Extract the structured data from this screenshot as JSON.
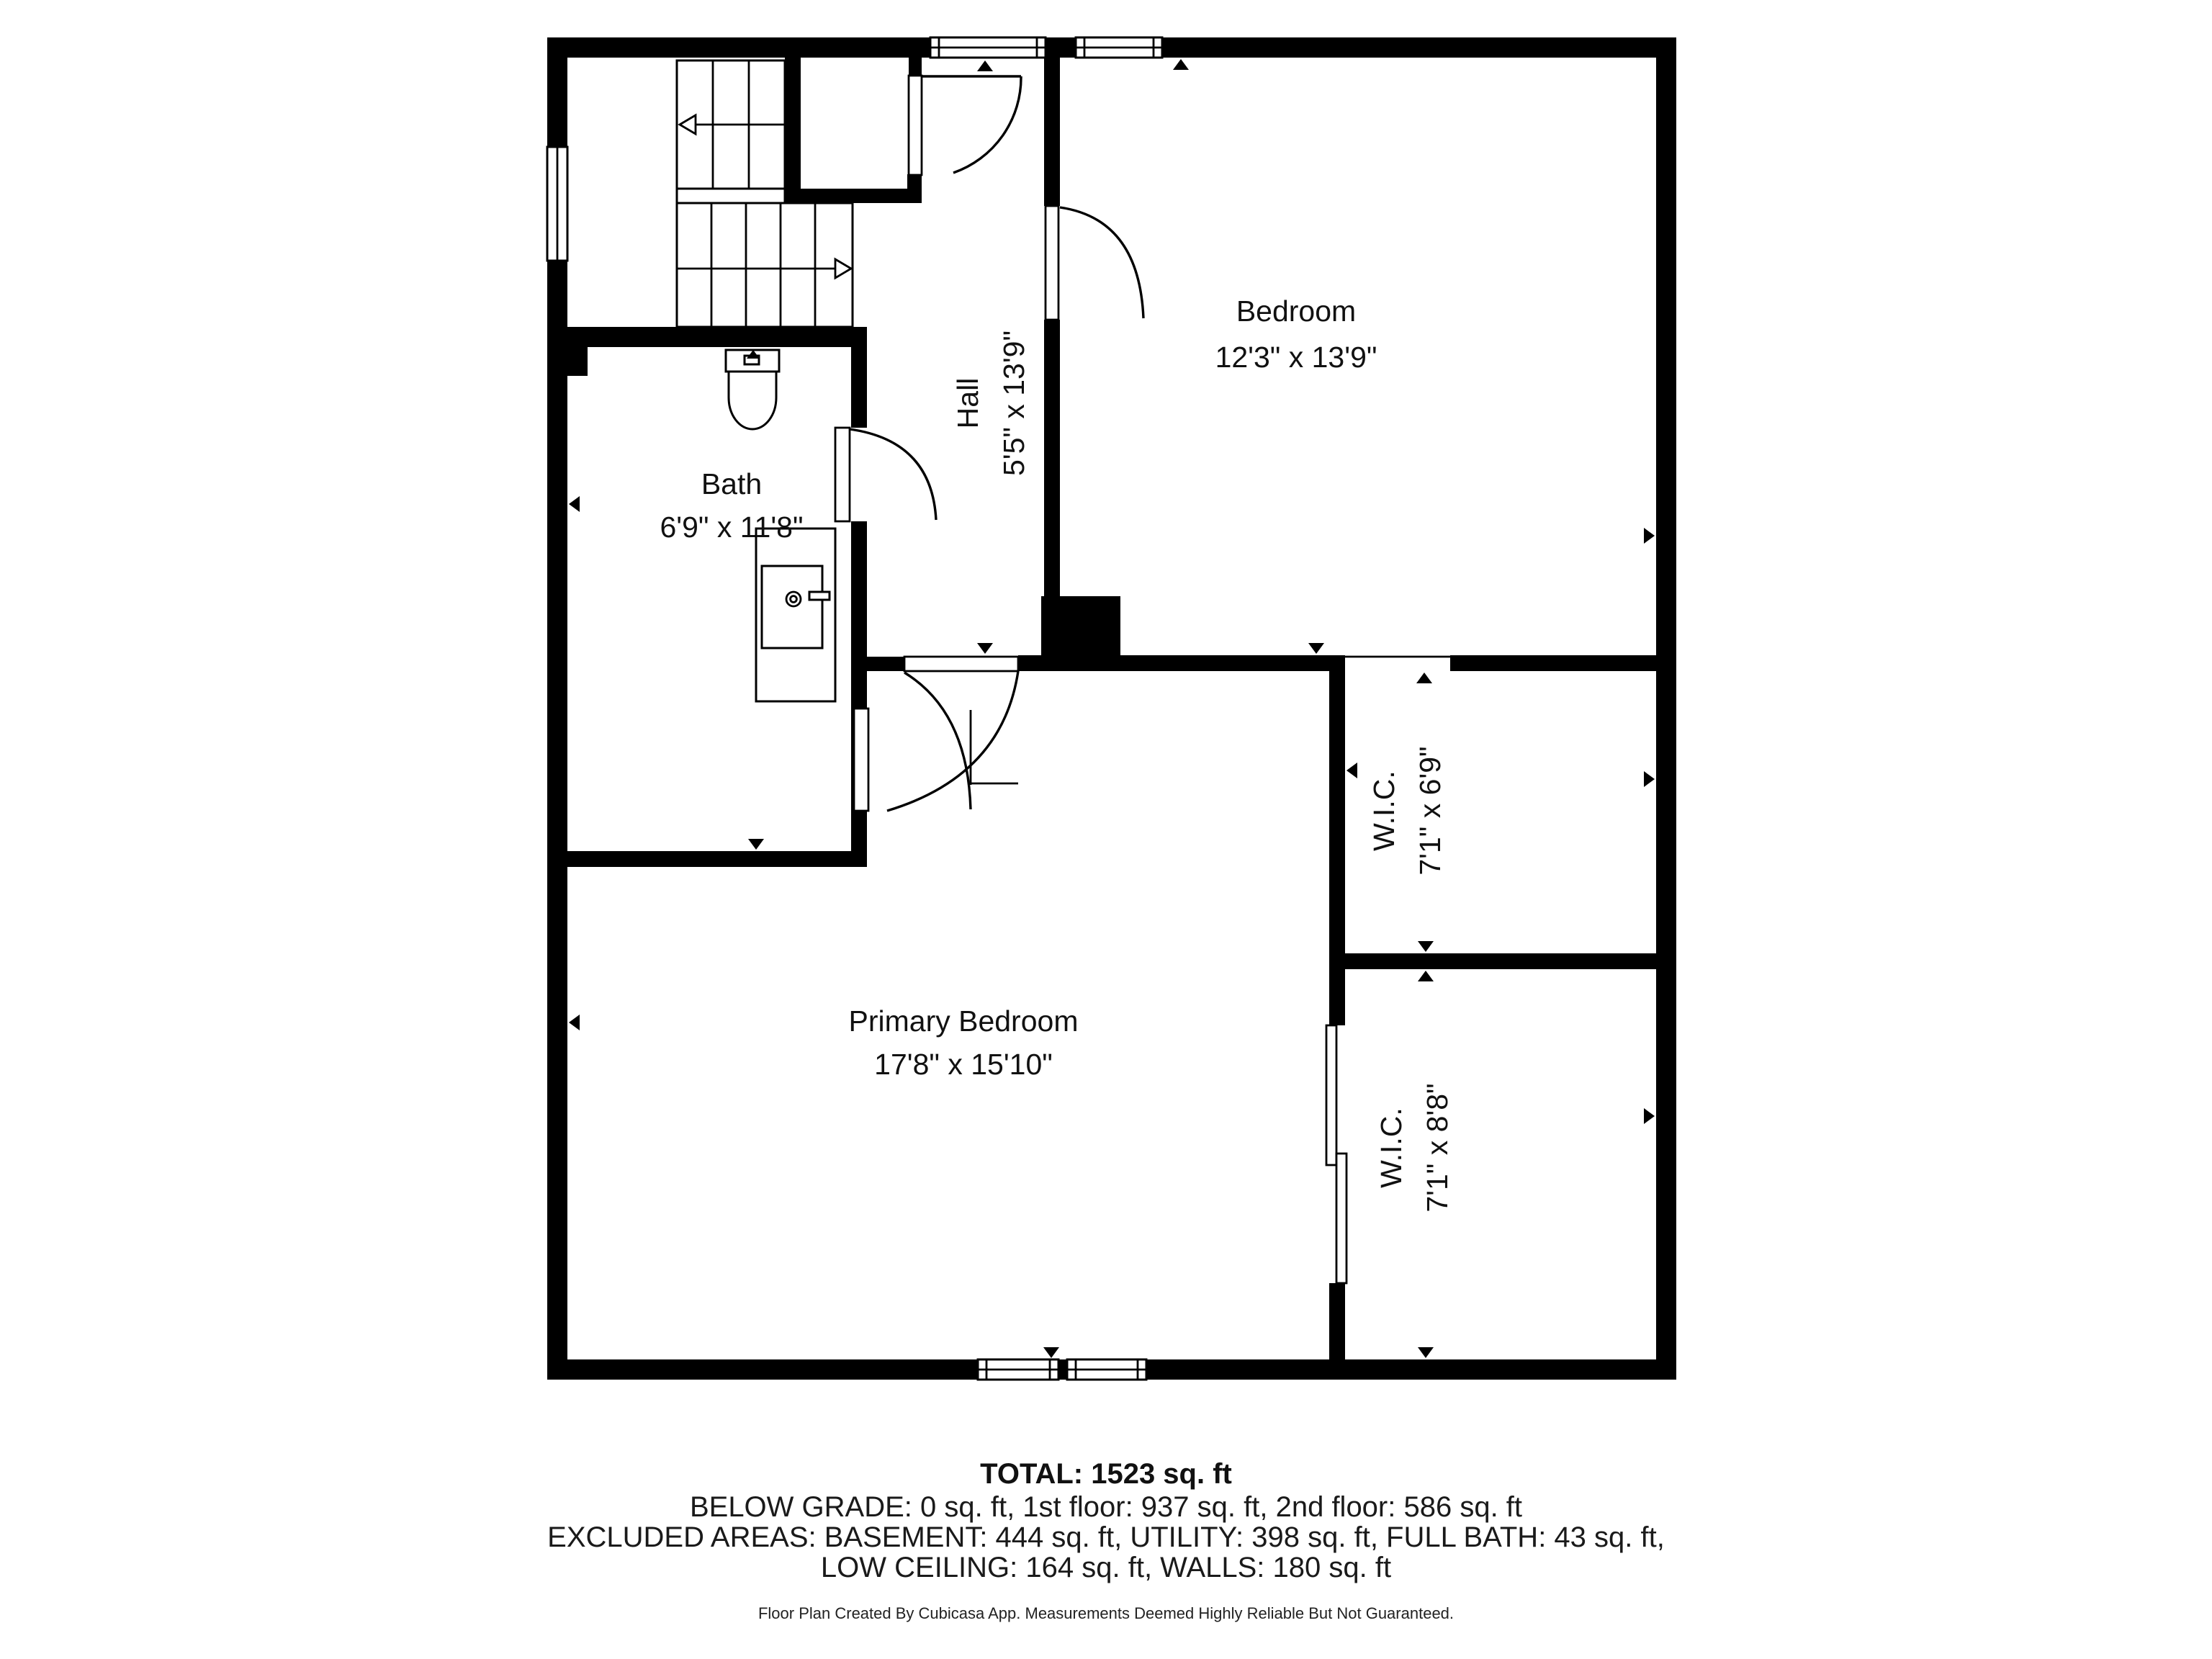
{
  "colors": {
    "wall": "#000000",
    "label_text": "#111111",
    "summary_text": "#1a1a1a",
    "background": "#ffffff"
  },
  "rooms": [
    {
      "name": "Bedroom",
      "dims": "12'3\" x 13'9\""
    },
    {
      "name": "Hall",
      "dims": "5'5\" x 13'9\""
    },
    {
      "name": "Bath",
      "dims": "6'9\" x 11'8\""
    },
    {
      "name": "Primary Bedroom",
      "dims": "17'8\" x 15'10\""
    },
    {
      "name": "W.I.C.",
      "dims": "7'1\" x 6'9\""
    },
    {
      "name": "W.I.C.",
      "dims": "7'1\" x 8'8\""
    }
  ],
  "summary": {
    "total": "TOTAL: 1523 sq. ft",
    "floors": "BELOW GRADE: 0 sq. ft, 1st floor: 937 sq. ft, 2nd floor: 586 sq. ft",
    "excluded_1": "EXCLUDED AREAS: BASEMENT: 444 sq. ft, UTILITY: 398 sq. ft, FULL BATH: 43 sq. ft,",
    "excluded_2": "LOW CEILING: 164 sq. ft, WALLS: 180 sq. ft"
  },
  "footer": "Floor Plan Created By Cubicasa App. Measurements Deemed Highly Reliable But Not Guaranteed.",
  "icons": {
    "toilet": "toilet-fixture-icon",
    "sink_vanity": "sink-vanity-fixture-icon",
    "wall_marker": "wall-measure-arrow-icon",
    "stair_arrow": "stair-direction-arrow-icon",
    "window": "window-symbol",
    "door": "door-swing-symbol"
  }
}
